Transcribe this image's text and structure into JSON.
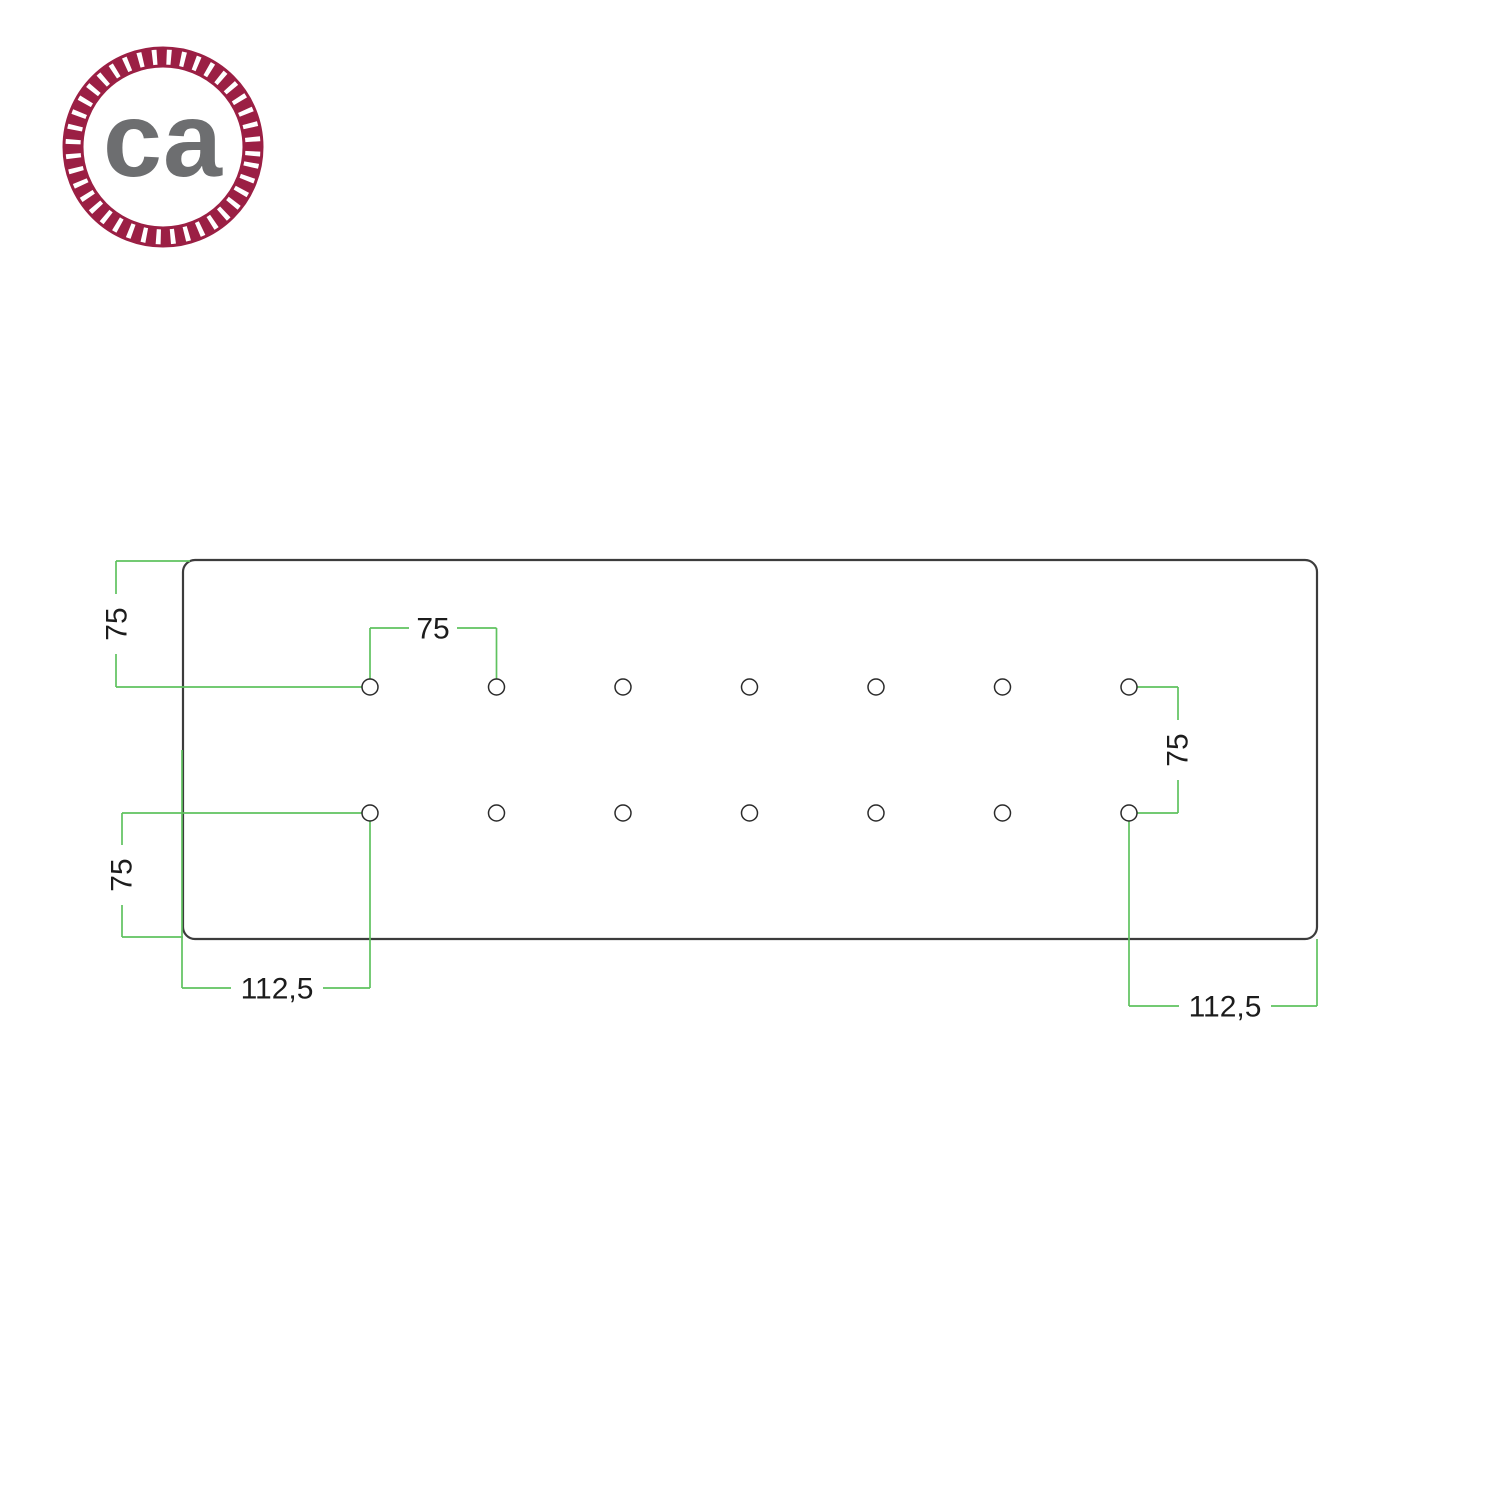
{
  "logo": {
    "text": "ca",
    "ring_color": "#9b1f44",
    "text_color": "#6d6e70"
  },
  "drawing": {
    "dimension_color": "#5fc25f",
    "outline_color": "#3c3c3c",
    "labels": {
      "plate_top_to_row": "75",
      "hole_to_hole": "75",
      "row_to_row": "75",
      "row_to_plate_bottom": "75",
      "left_edge_to_column": "112,5",
      "right_edge_to_column": "112,5"
    },
    "holes": {
      "columns": [
        370,
        496.5,
        623,
        749.5,
        876,
        1002.5,
        1129
      ],
      "rows": [
        687,
        813
      ],
      "radius": 8
    }
  }
}
